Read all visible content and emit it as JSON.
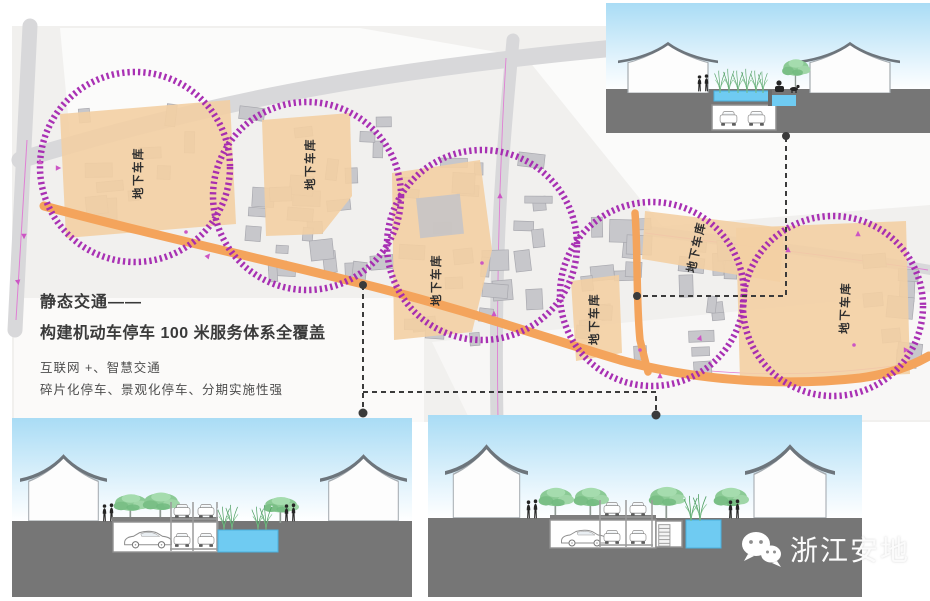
{
  "slide": {
    "title": "静态交通——",
    "subtitle": "构建机动车停车 100 米服务体系全覆盖",
    "bullet1": "互联网 +、智慧交通",
    "bullet2": "碎片化停车、景观化停车、分期实施性强"
  },
  "map": {
    "garage_label": "地下车库",
    "building_clusters": [
      {
        "x": 232,
        "y": 95,
        "w": 162,
        "h": 190,
        "n": 26
      },
      {
        "x": 397,
        "y": 152,
        "w": 158,
        "h": 195,
        "n": 26
      },
      {
        "x": 562,
        "y": 215,
        "w": 92,
        "h": 165,
        "n": 15
      },
      {
        "x": 662,
        "y": 238,
        "w": 80,
        "h": 140,
        "n": 12
      },
      {
        "x": 70,
        "y": 102,
        "w": 165,
        "h": 135,
        "n": 10
      },
      {
        "x": 858,
        "y": 250,
        "w": 66,
        "h": 118,
        "n": 8
      }
    ],
    "markers": [
      [
        40,
        162,
        0
      ],
      [
        24,
        236,
        180
      ],
      [
        18,
        282,
        170
      ],
      [
        58,
        168,
        90
      ],
      [
        208,
        256,
        40
      ],
      [
        500,
        196,
        0
      ],
      [
        494,
        314,
        0
      ],
      [
        700,
        338,
        20
      ],
      [
        858,
        234,
        0
      ],
      [
        906,
        350,
        90
      ],
      [
        660,
        376,
        0
      ],
      [
        788,
        250,
        0
      ]
    ],
    "dots": [
      [
        186,
        232
      ],
      [
        482,
        263
      ],
      [
        854,
        345
      ],
      [
        640,
        350
      ]
    ]
  },
  "watermark": {
    "brand": "浙江安地"
  },
  "colors": {
    "purple_circle": "#a426b0",
    "orange_road": "#f4a45c",
    "parcel": "#f3cfa3",
    "map_bg": "#f1f0ee",
    "road_gray": "#d8d8da",
    "building_gray": "#c7c7cb",
    "ground": "#767676",
    "slab": "#7e7e7e",
    "water": "#6fcbf2",
    "water_edge": "#4ab0de",
    "sky_top": "#a9dcf5",
    "tree_green": "#8bca95",
    "connector": "#3b3b3b",
    "pink_line": "#e07fd4",
    "pink_marker": "#cc55c4"
  }
}
